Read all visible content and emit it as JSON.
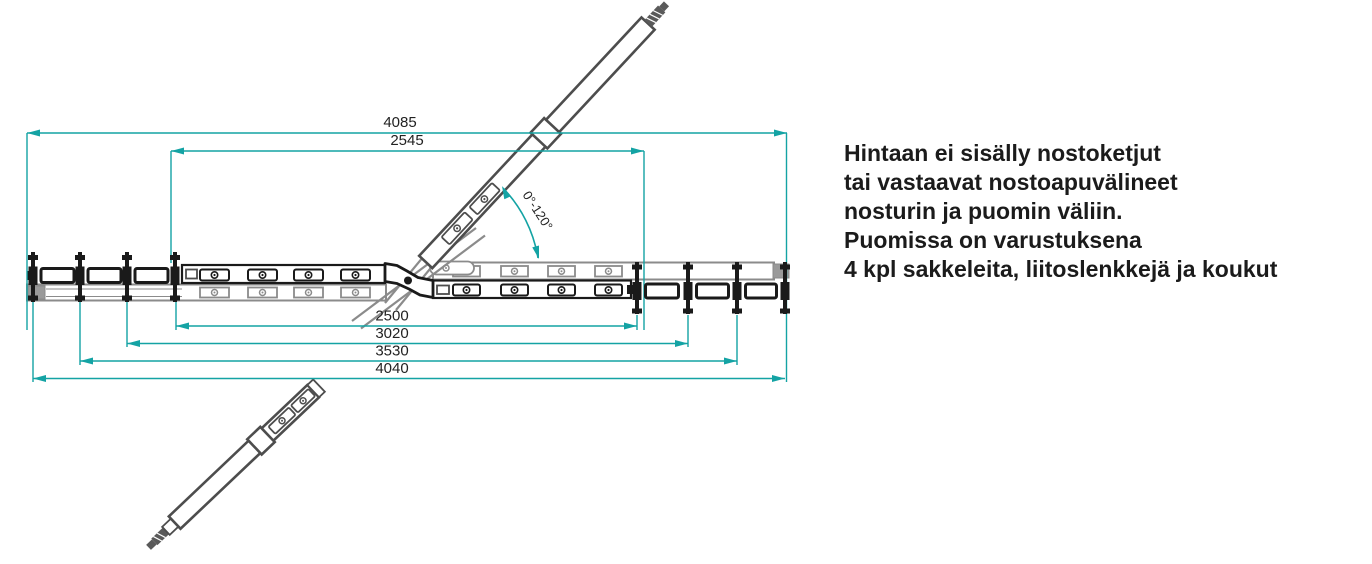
{
  "colors": {
    "dimension": "#14a3a4",
    "drawing_dark": "#1a1a1a",
    "drawing_gray": "#8b8b8b",
    "arm_gray": "#4d4d4d",
    "note_text": "#1b1b1b",
    "background": "#ffffff"
  },
  "diagram": {
    "dimensions_top": [
      {
        "label": "4085"
      },
      {
        "label": "2545"
      }
    ],
    "dimensions_bottom": [
      {
        "label": "2500"
      },
      {
        "label": "3020"
      },
      {
        "label": "3530"
      },
      {
        "label": "4040"
      }
    ],
    "angle_label": "0°-120°"
  },
  "note": {
    "lines": [
      "Hintaan ei sisälly nostoketjut",
      "tai vastaavat nostoapuvälineet",
      "nosturin ja puomin väliin.",
      "Puomissa on varustuksena",
      "4 kpl sakkeleita, liitoslenkkejä ja koukut"
    ]
  }
}
